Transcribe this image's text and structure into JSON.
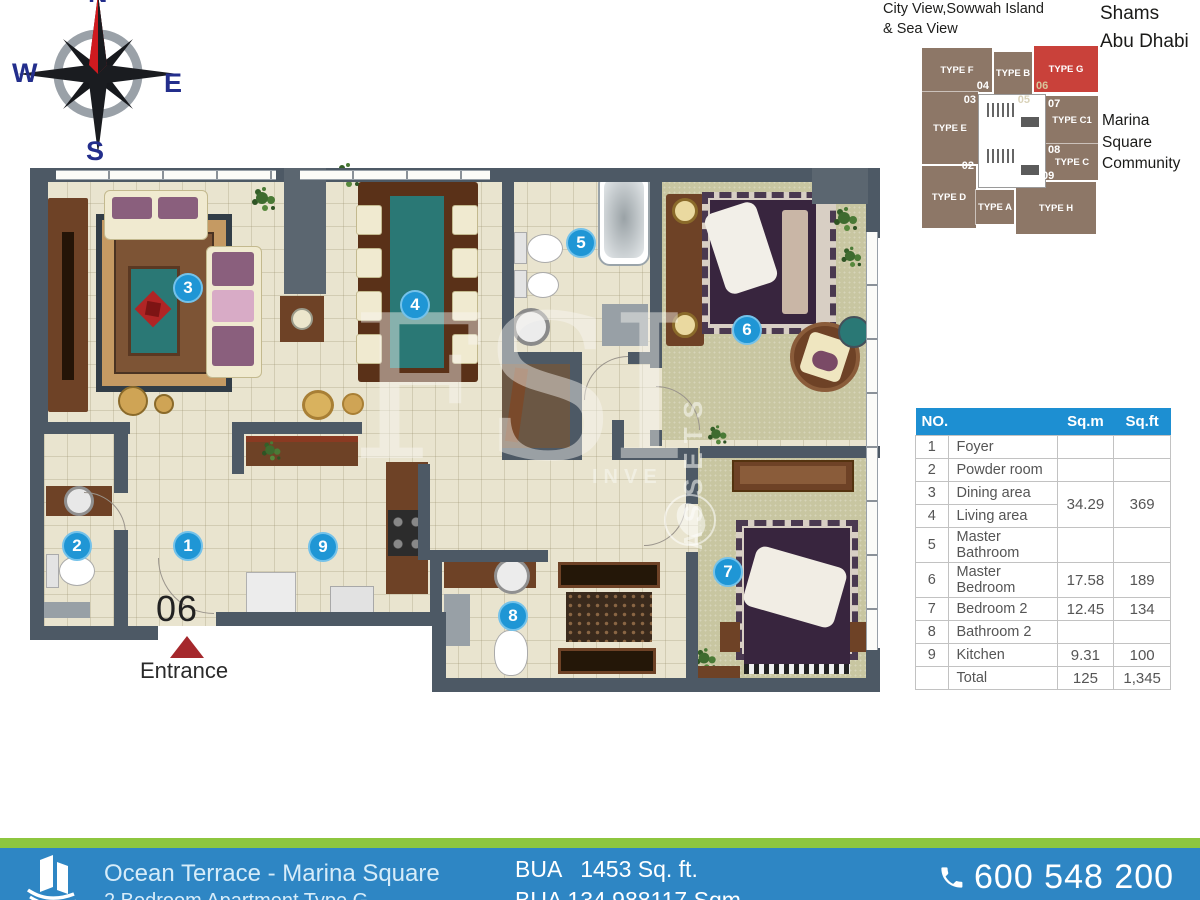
{
  "header": {
    "view_caption_line1": "City View,Sowwah Island",
    "view_caption_line2": "& Sea View",
    "location_line1": "Shams",
    "location_line2": "Abu Dhabi",
    "community_line1": "Marina Square",
    "community_line2": "Community"
  },
  "compass": {
    "n": "N",
    "w": "W",
    "e": "E",
    "s": "S"
  },
  "keyplan": {
    "block_color": "#8d7767",
    "highlight_color": "#c9413a",
    "units": [
      {
        "label": "TYPE F",
        "number": "04"
      },
      {
        "label": "TYPE B",
        "number": "05"
      },
      {
        "label": "TYPE G",
        "number": "06"
      },
      {
        "label": "TYPE E",
        "number": "03"
      },
      {
        "label": "TYPE C1",
        "number": "07"
      },
      {
        "label": "TYPE C",
        "number": "08"
      },
      {
        "label": "TYPE D",
        "number": "02"
      },
      {
        "label": "TYPE A",
        "number": "01"
      },
      {
        "label": "TYPE H",
        "number": "09"
      }
    ]
  },
  "plan": {
    "unit_number": "06",
    "entrance_label": "Entrance",
    "badges": [
      {
        "number": "1",
        "room": "Foyer"
      },
      {
        "number": "2",
        "room": "Powder room"
      },
      {
        "number": "3",
        "room": "Dining area"
      },
      {
        "number": "4",
        "room": "Living area"
      },
      {
        "number": "5",
        "room": "Master Bathroom"
      },
      {
        "number": "6",
        "room": "Master Bedroom"
      },
      {
        "number": "7",
        "room": "Bedroom 2"
      },
      {
        "number": "8",
        "room": "Bathroom 2"
      },
      {
        "number": "9",
        "room": "Kitchen"
      }
    ]
  },
  "watermark": {
    "big": "FSI",
    "vertical": "ASSETS",
    "small": "INVE"
  },
  "area_table": {
    "header_color": "#1d8fd2",
    "headers": {
      "no": "NO.",
      "sqm": "Sq.m",
      "sqft": "Sq.ft"
    },
    "rows": [
      {
        "no": "1",
        "name": "Foyer",
        "sqm": "",
        "sqft": ""
      },
      {
        "no": "2",
        "name": "Powder room",
        "sqm": "",
        "sqft": ""
      },
      {
        "no": "3",
        "name": "Dining area",
        "sqm": "34.29",
        "sqft": "369"
      },
      {
        "no": "4",
        "name": "Living area"
      },
      {
        "no": "5",
        "name": "Master Bathroom",
        "sqm": "",
        "sqft": ""
      },
      {
        "no": "6",
        "name": "Master Bedroom",
        "sqm": "17.58",
        "sqft": "189"
      },
      {
        "no": "7",
        "name": "Bedroom 2",
        "sqm": "12.45",
        "sqft": "134"
      },
      {
        "no": "8",
        "name": "Bathroom 2",
        "sqm": "",
        "sqft": ""
      },
      {
        "no": "9",
        "name": "Kitchen",
        "sqm": "9.31",
        "sqft": "100"
      },
      {
        "no": "",
        "name": "Total",
        "sqm": "125",
        "sqft": "1,345"
      }
    ]
  },
  "footer": {
    "stripe_color": "#8dc63f",
    "bar_color": "#2e86c4",
    "project_title": "Ocean Terrace - Marina Square",
    "project_subtitle": "2 Bedroom Apartment Type G",
    "bua_line1": "BUA   1453 Sq. ft.",
    "bua_line2": "BUA 134.988117 Sqm",
    "phone": "600 548 200"
  }
}
